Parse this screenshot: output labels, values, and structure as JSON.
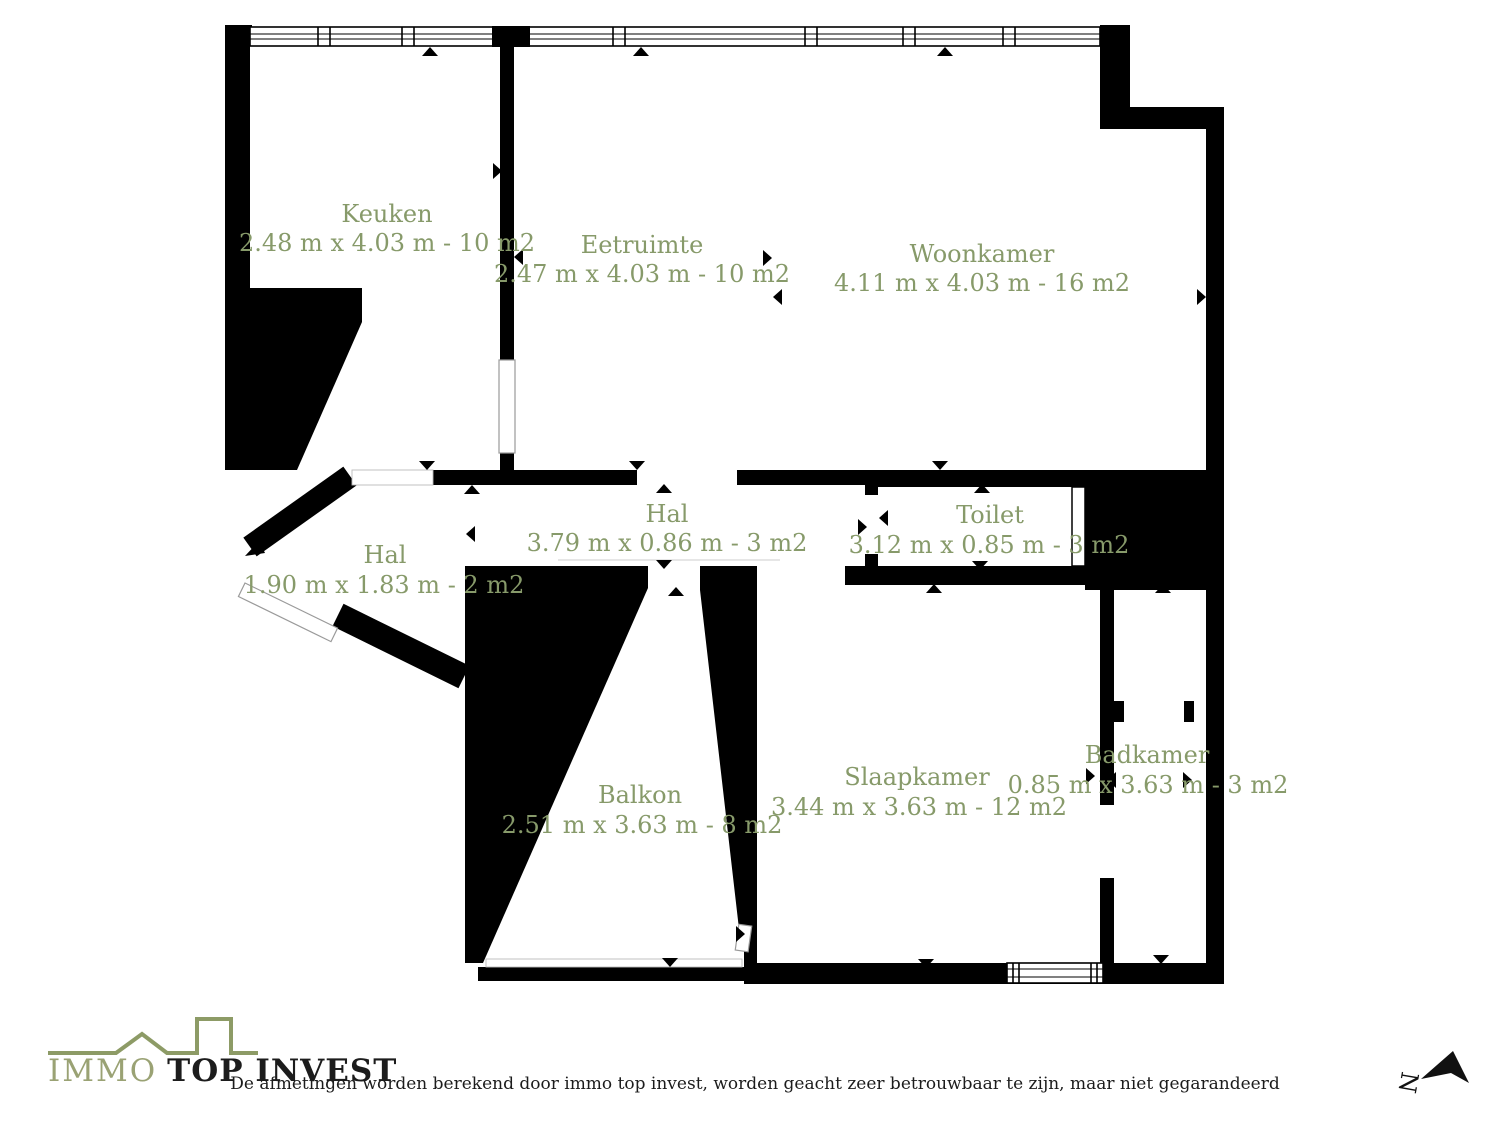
{
  "colors": {
    "wall": "#000000",
    "label": "#879a6a",
    "logo_accent": "#8d9b66",
    "logo_immo": "#9aa274",
    "logo_text": "#1c1c1c"
  },
  "rooms": [
    {
      "id": "keuken",
      "name": "Keuken",
      "dims": "2.48 m x 4.03 m - 10 m2"
    },
    {
      "id": "eetruimte",
      "name": "Eetruimte",
      "dims": "2.47 m x 4.03 m - 10 m2"
    },
    {
      "id": "woonkamer",
      "name": "Woonkamer",
      "dims": "4.11 m x 4.03 m - 16 m2"
    },
    {
      "id": "hal-center",
      "name": "Hal",
      "dims": "3.79 m x 0.86 m - 3 m2"
    },
    {
      "id": "toilet",
      "name": "Toilet",
      "dims": "3.12 m x 0.85 m - 3 m2"
    },
    {
      "id": "hal-left",
      "name": "Hal",
      "dims": "1.90 m x 1.83 m - 2 m2"
    },
    {
      "id": "balkon",
      "name": "Balkon",
      "dims": "2.51 m x 3.63 m - 8 m2"
    },
    {
      "id": "slaapkamer",
      "name": "Slaapkamer",
      "dims": "3.44 m x 3.63 m - 12 m2"
    },
    {
      "id": "badkamer",
      "name": "Badkamer",
      "dims": "0.85 m x 3.63 m - 3 m2"
    }
  ],
  "logo": {
    "word1": "IMMO",
    "word2": "TOP INVEST"
  },
  "footer": {
    "disclaimer": "De afmetingen worden berekend door immo top invest, worden geacht zeer betrouwbaar te zijn, maar niet gegarandeerd"
  },
  "compass": {
    "letter": "N"
  }
}
